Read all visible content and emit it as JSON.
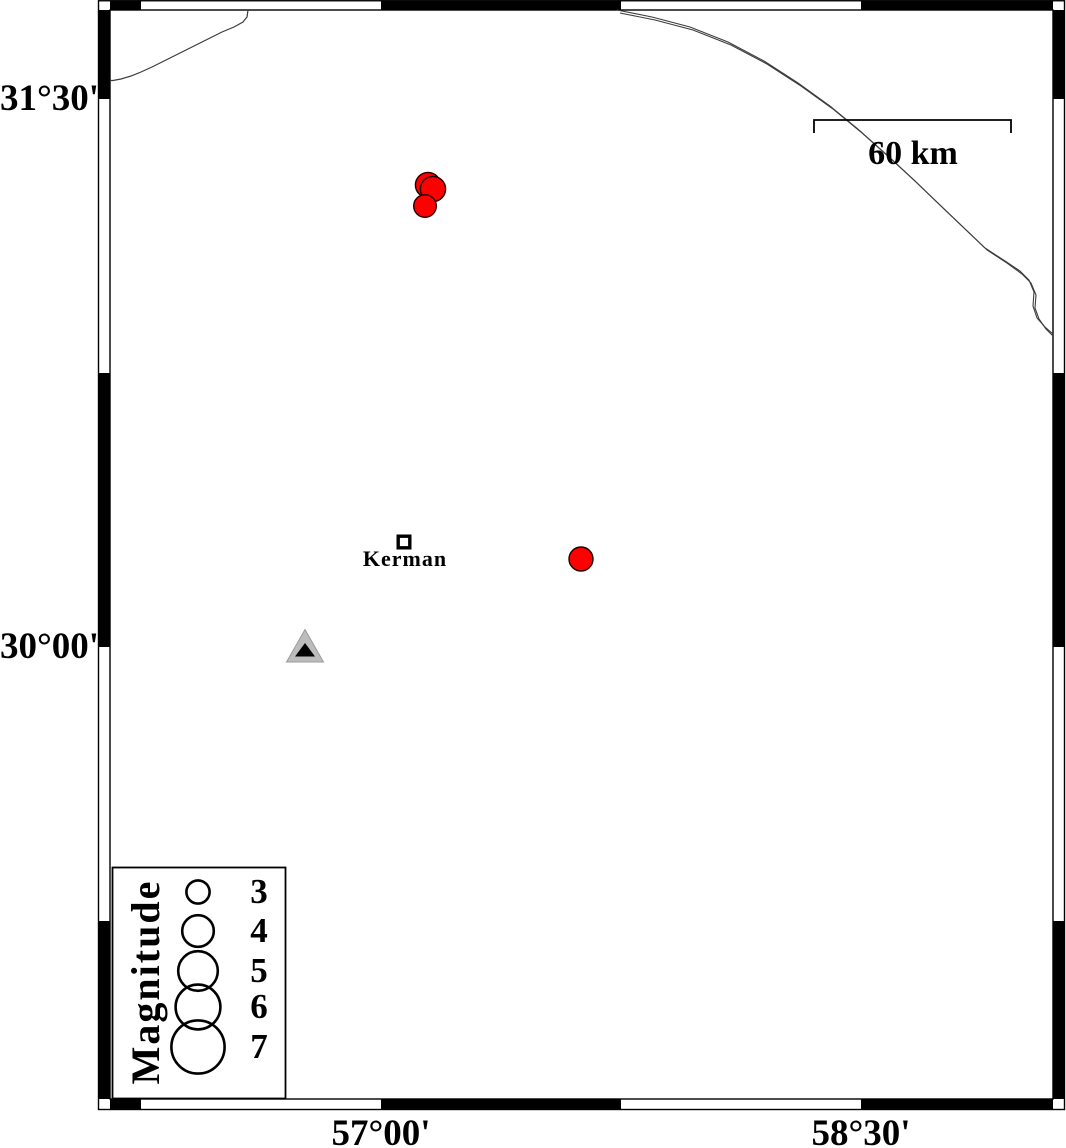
{
  "map": {
    "axis": {
      "left_ticks": [
        {
          "label": "31°30'",
          "y": 99
        },
        {
          "label": "30°00'",
          "y": 647
        }
      ],
      "bottom_ticks": [
        {
          "label": "57°00'",
          "x": 381
        },
        {
          "label": "58°30'",
          "x": 861
        }
      ]
    },
    "scale_bar": {
      "label": "60 km",
      "x1": 814,
      "x2": 1011,
      "y": 120,
      "tick_len": 13
    },
    "city": {
      "name": "Kerman",
      "x": 404,
      "y": 542,
      "marker_size": 11.6
    },
    "station": {
      "x": 305,
      "base_y": 662,
      "half_width": 18.5,
      "apex_y": 629.5,
      "inner_half_width": 10,
      "inner_base_y": 656.5,
      "inner_apex_y": 643
    },
    "earthquakes": [
      {
        "x": 428,
        "y": 185,
        "r": 12.6
      },
      {
        "x": 433,
        "y": 189,
        "r": 12.6
      },
      {
        "x": 425,
        "y": 206,
        "r": 11.3
      },
      {
        "x": 581,
        "y": 559,
        "r": 12.0
      }
    ],
    "boundaries": {
      "line1": [
        [
          248,
          10
        ],
        [
          247,
          17
        ],
        [
          243,
          22
        ],
        [
          234,
          27
        ],
        [
          222,
          32
        ],
        [
          208,
          39
        ],
        [
          194,
          46
        ],
        [
          180,
          53
        ],
        [
          166,
          60
        ],
        [
          152,
          67
        ],
        [
          141,
          72
        ],
        [
          131,
          76
        ],
        [
          121,
          79
        ],
        [
          113,
          80.5
        ],
        [
          110,
          80.5
        ]
      ],
      "line2_upper": [
        [
          617,
          10
        ],
        [
          652,
          17
        ],
        [
          690,
          27
        ],
        [
          728,
          42
        ],
        [
          764,
          61
        ],
        [
          798,
          83
        ],
        [
          830,
          106
        ],
        [
          859,
          130
        ],
        [
          887,
          155
        ],
        [
          914,
          180
        ],
        [
          940,
          205
        ],
        [
          962,
          226
        ],
        [
          985,
          248
        ],
        [
          1005,
          261
        ],
        [
          1020,
          271
        ],
        [
          1029,
          280
        ],
        [
          1034,
          292
        ],
        [
          1033,
          306
        ],
        [
          1037,
          318
        ],
        [
          1045,
          327
        ],
        [
          1053,
          334
        ]
      ],
      "line2_lower": [
        [
          620,
          13
        ],
        [
          655,
          20
        ],
        [
          693,
          30
        ],
        [
          731,
          45
        ],
        [
          767,
          64
        ],
        [
          801,
          86
        ],
        [
          833,
          109
        ],
        [
          862,
          133
        ],
        [
          890,
          158
        ],
        [
          917,
          183
        ],
        [
          943,
          208
        ],
        [
          965,
          229
        ],
        [
          987,
          250
        ],
        [
          1007,
          263
        ],
        [
          1022,
          274
        ],
        [
          1031,
          283
        ],
        [
          1036,
          295
        ],
        [
          1035,
          308
        ],
        [
          1039,
          319
        ],
        [
          1046,
          329
        ],
        [
          1053,
          336
        ]
      ]
    },
    "colors": {
      "earthquake_fill": "#ff0000",
      "earthquake_stroke": "#1e0000",
      "station_fill": "#bcbcbc",
      "station_stroke": "#9b9b9b",
      "station_inner_fill": "#000000",
      "boundary_line": "#3c3c3c",
      "frame": "#000000"
    }
  },
  "legend": {
    "title": "Magnitude",
    "circle_x": 198,
    "entries": [
      {
        "label": "3",
        "r": 11.6,
        "y": 892
      },
      {
        "label": "4",
        "r": 15.8,
        "y": 931
      },
      {
        "label": "5",
        "r": 19.8,
        "y": 971
      },
      {
        "label": "6",
        "r": 22.4,
        "y": 1007
      },
      {
        "label": "7",
        "r": 26.6,
        "y": 1047
      }
    ]
  }
}
